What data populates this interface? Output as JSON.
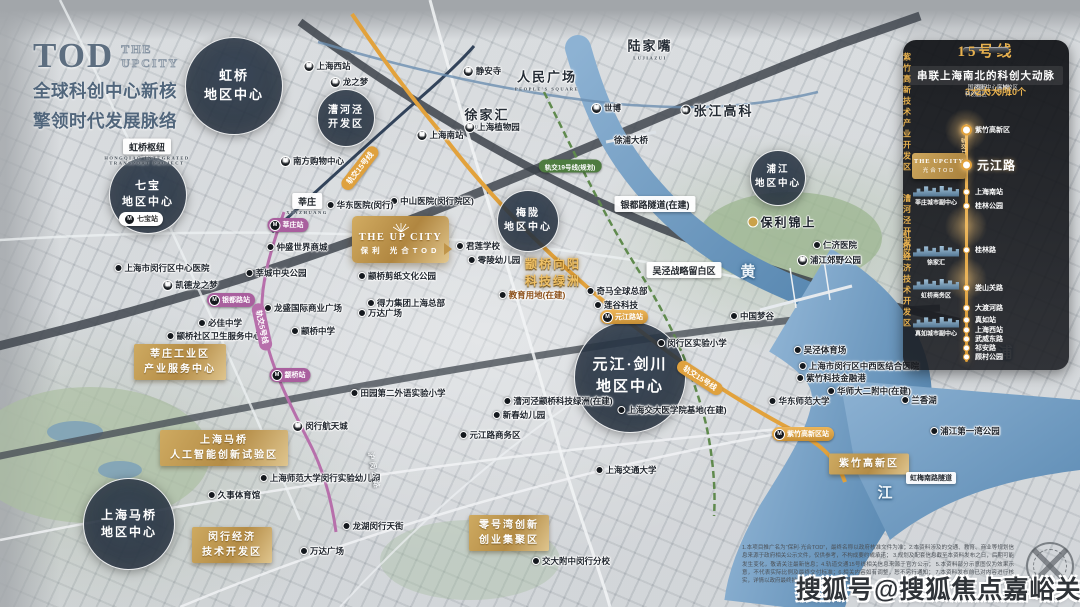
{
  "title_block": {
    "logo": "TOD",
    "logo_sub1": "THE",
    "logo_sub2": "UPCITY",
    "line1": "全球科创中心新核",
    "line2": "擎领时代发展脉络"
  },
  "project_box": {
    "en": "THE UP CITY",
    "cn": "保利 光合TOD"
  },
  "watermark": {
    "text": "搜狐号@搜狐焦点嘉峪关站"
  },
  "colors": {
    "gold": "#d8a94f",
    "panel_bg": "#16181c",
    "circle": "#2c3a4b",
    "line15": "#e2a23c",
    "line5": "#b76fab",
    "line19": "#5f8a4d",
    "line1": "#32435a",
    "river": "#6f9cbb"
  },
  "region_circles": [
    {
      "lines": [
        "虹桥",
        "地区中心"
      ],
      "x": 233,
      "y": 85,
      "r": 48,
      "fs": 13
    },
    {
      "lines": [
        "七宝",
        "地区中心"
      ],
      "x": 147,
      "y": 194,
      "r": 38,
      "fs": 11
    },
    {
      "lines": [
        "漕河泾",
        "开发区"
      ],
      "x": 345,
      "y": 117,
      "r": 28,
      "fs": 10
    },
    {
      "lines": [
        "梅陇",
        "地区中心"
      ],
      "x": 527,
      "y": 220,
      "r": 30,
      "fs": 10
    },
    {
      "lines": [
        "元江·剑川",
        "地区中心"
      ],
      "x": 629,
      "y": 376,
      "r": 55,
      "fs": 15
    },
    {
      "lines": [
        "上海马桥",
        "地区中心"
      ],
      "x": 128,
      "y": 523,
      "r": 45,
      "fs": 12
    },
    {
      "lines": [
        "浦江",
        "地区中心"
      ],
      "x": 777,
      "y": 177,
      "r": 27,
      "fs": 9.5
    }
  ],
  "gold_labels": [
    {
      "k": "pill",
      "lines": [
        "莘庄工业区",
        "产业服务中心"
      ],
      "x": 180,
      "y": 362
    },
    {
      "k": "pill",
      "lines": [
        "上海马桥",
        "人工智能创新试验区"
      ],
      "x": 224,
      "y": 448
    },
    {
      "k": "pill",
      "lines": [
        "闵行经济",
        "技术开发区"
      ],
      "x": 232,
      "y": 545
    },
    {
      "k": "pill",
      "lines": [
        "零号湾创新",
        "创业集聚区"
      ],
      "x": 509,
      "y": 533
    },
    {
      "k": "pill",
      "lines": [
        "紫竹高新区"
      ],
      "x": 869,
      "y": 464
    },
    {
      "k": "text",
      "lines": [
        "颛桥向阳",
        "科技绿洲"
      ],
      "x": 553,
      "y": 273
    }
  ],
  "map_labels": [
    {
      "t": "上海西站",
      "x": 327,
      "y": 66,
      "icon": "m"
    },
    {
      "t": "龙之梦",
      "x": 349,
      "y": 82,
      "icon": "m"
    },
    {
      "t": "静安寺",
      "x": 482,
      "y": 71,
      "icon": "m"
    },
    {
      "t": "人民广场",
      "sub": "PEOPLE'S SQUARE",
      "x": 547,
      "y": 79,
      "s": "serif"
    },
    {
      "t": "陆家嘴",
      "sub": "LUJIAZUI",
      "x": 650,
      "y": 48,
      "s": "serif"
    },
    {
      "t": "张江高科",
      "x": 717,
      "y": 110,
      "s": "serif",
      "icon": "m"
    },
    {
      "t": "徐家汇",
      "sub": "XUJIAHUI",
      "x": 487,
      "y": 117,
      "s": "serif"
    },
    {
      "t": "世博",
      "x": 606,
      "y": 108,
      "icon": "m"
    },
    {
      "t": "上海南站",
      "x": 440,
      "y": 135,
      "icon": "m"
    },
    {
      "t": "上海植物园",
      "x": 492,
      "y": 127,
      "icon": "m"
    },
    {
      "t": "徐浦大桥",
      "x": 631,
      "y": 140
    },
    {
      "t": "南方购物中心",
      "x": 312,
      "y": 161,
      "icon": "m"
    },
    {
      "t": "虹桥枢纽",
      "sub": "HONGQIAO INTEGRATED TRANSPORT PROJECT",
      "x": 147,
      "y": 152,
      "s": "tag"
    },
    {
      "t": "莘庄",
      "sub": "XINZHUANG",
      "x": 307,
      "y": 204,
      "s": "tag"
    },
    {
      "t": "银都路隧道(在建)",
      "x": 655,
      "y": 204,
      "s": "tag"
    },
    {
      "t": "吴泾战略留白区",
      "x": 684,
      "y": 270,
      "s": "tag"
    },
    {
      "t": "虹梅南路隧道",
      "x": 931,
      "y": 478,
      "s": "tag-s"
    },
    {
      "t": "保利锦上",
      "x": 782,
      "y": 222,
      "s": "poi",
      "icon": "pin"
    },
    {
      "t": "仲盛世界商城",
      "x": 297,
      "y": 247,
      "icon": "dot"
    },
    {
      "t": "莘城中央公园",
      "x": 276,
      "y": 273,
      "icon": "dot"
    },
    {
      "t": "上海市闵行区中心医院",
      "x": 162,
      "y": 268,
      "icon": "dot"
    },
    {
      "t": "凯德龙之梦",
      "x": 190,
      "y": 285,
      "icon": "m"
    },
    {
      "t": "龙盛国际商业广场",
      "x": 303,
      "y": 308,
      "icon": "dot"
    },
    {
      "t": "必佳中学",
      "x": 220,
      "y": 323,
      "icon": "dot"
    },
    {
      "t": "颛桥社区卫生服务中心",
      "x": 214,
      "y": 336,
      "icon": "dot"
    },
    {
      "t": "颛桥中学",
      "x": 313,
      "y": 331,
      "icon": "dot"
    },
    {
      "t": "中山医院(闵行院区)",
      "x": 432,
      "y": 201,
      "icon": "dot"
    },
    {
      "t": "华东医院(闵行)",
      "x": 360,
      "y": 205,
      "icon": "dot"
    },
    {
      "t": "君莲学校",
      "x": 478,
      "y": 246,
      "icon": "dot"
    },
    {
      "t": "零陵幼儿园",
      "x": 494,
      "y": 260,
      "icon": "dot"
    },
    {
      "t": "颛桥剪纸文化公园",
      "x": 397,
      "y": 276,
      "icon": "dot"
    },
    {
      "t": "得力集团上海总部",
      "x": 406,
      "y": 303,
      "icon": "dot"
    },
    {
      "t": "万达广场",
      "x": 380,
      "y": 313,
      "icon": "dot"
    },
    {
      "t": "教育用地(在建)",
      "x": 532,
      "y": 295,
      "icon": "dot",
      "s": "orange"
    },
    {
      "t": "奇马全球总部",
      "x": 617,
      "y": 291,
      "icon": "dot"
    },
    {
      "t": "莲谷科技",
      "x": 616,
      "y": 305,
      "icon": "dot"
    },
    {
      "t": "中国梦谷",
      "x": 752,
      "y": 316,
      "icon": "dot"
    },
    {
      "t": "闵行区实验小学",
      "x": 692,
      "y": 343,
      "icon": "dot"
    },
    {
      "t": "吴泾体育场",
      "x": 820,
      "y": 350,
      "icon": "dot"
    },
    {
      "t": "上海市闵行区中西医结合医院",
      "x": 859,
      "y": 366,
      "icon": "dot"
    },
    {
      "t": "紫竹科技金融港",
      "x": 831,
      "y": 378,
      "icon": "dot"
    },
    {
      "t": "华师大二附中(在建)",
      "x": 869,
      "y": 391,
      "icon": "dot"
    },
    {
      "t": "华东师范大学",
      "x": 799,
      "y": 401,
      "icon": "dot"
    },
    {
      "t": "兰香湖",
      "x": 919,
      "y": 400,
      "icon": "dot"
    },
    {
      "t": "浦江第一湾公园",
      "x": 965,
      "y": 431,
      "icon": "dot"
    },
    {
      "t": "上海交通大学",
      "x": 626,
      "y": 470,
      "icon": "dot"
    },
    {
      "t": "上海交大医学院基地(在建)",
      "x": 672,
      "y": 410,
      "icon": "dot"
    },
    {
      "t": "田园第二外语实验小学",
      "x": 398,
      "y": 393,
      "icon": "dot"
    },
    {
      "t": "漕河泾颛桥科技绿洲(在建)",
      "x": 558,
      "y": 401,
      "icon": "dot"
    },
    {
      "t": "新春幼儿园",
      "x": 519,
      "y": 415,
      "icon": "dot"
    },
    {
      "t": "元江路商务区",
      "x": 490,
      "y": 435,
      "icon": "dot"
    },
    {
      "t": "闵行航天城",
      "x": 320,
      "y": 426,
      "icon": "m"
    },
    {
      "t": "上海师范大学闵行实验幼儿园",
      "x": 320,
      "y": 478,
      "icon": "dot"
    },
    {
      "t": "久事体育馆",
      "x": 234,
      "y": 495,
      "icon": "dot"
    },
    {
      "t": "万达广场",
      "x": 322,
      "y": 551,
      "icon": "dot"
    },
    {
      "t": "龙湖闵行天街",
      "x": 373,
      "y": 526,
      "icon": "dot"
    },
    {
      "t": "交大附中闵行分校",
      "x": 571,
      "y": 561,
      "icon": "dot"
    },
    {
      "t": "仁济医院",
      "x": 835,
      "y": 245,
      "icon": "dot"
    },
    {
      "t": "浦江郊野公园",
      "x": 829,
      "y": 260,
      "icon": "m"
    },
    {
      "t": "元江路站",
      "x": 624,
      "y": 317,
      "s": "bgold",
      "icon": "m"
    },
    {
      "t": "紫竹高新区站",
      "x": 803,
      "y": 434,
      "s": "bgold",
      "icon": "m"
    },
    {
      "t": "七宝站",
      "x": 141,
      "y": 219,
      "s": "bwhite",
      "icon": "m"
    },
    {
      "t": "莘庄站",
      "x": 288,
      "y": 225,
      "s": "bpink",
      "icon": "m"
    },
    {
      "t": "银都路站",
      "x": 231,
      "y": 300,
      "s": "bpink",
      "icon": "m"
    },
    {
      "t": "颛桥站",
      "x": 290,
      "y": 375,
      "s": "bpink",
      "icon": "m"
    },
    {
      "t": "轨交19号线(规划)",
      "x": 570,
      "y": 166,
      "s": "bgreen"
    },
    {
      "t": "轨交15号线",
      "x": 360,
      "y": 168,
      "rot": -52,
      "s": "rgold"
    },
    {
      "t": "轨交15号线",
      "x": 700,
      "y": 378,
      "rot": 33,
      "s": "rgold"
    },
    {
      "t": "轨交5号线",
      "x": 262,
      "y": 327,
      "rot": 78,
      "s": "rpink"
    },
    {
      "t": "沪闵公路",
      "x": 374,
      "y": 471,
      "rot": 80,
      "s": "rgray"
    }
  ],
  "river_chars": [
    {
      "t": "黄",
      "x": 749,
      "y": 271
    },
    {
      "t": "浦",
      "x": 1006,
      "y": 352
    },
    {
      "t": "江",
      "x": 886,
      "y": 492
    }
  ],
  "panel": {
    "line_name": "15号线",
    "headline": "串联上海南北的科创大动脉",
    "stats": [
      {
        "n": "3大",
        "t": "国家级\n科创园区"
      },
      {
        "n": "2大",
        "t": "枢纽"
      },
      {
        "n": "3大",
        "t": "中心区域"
      },
      {
        "n": "9所",
        "t": "高校"
      },
      {
        "n": "10个",
        "t": "校区"
      }
    ],
    "line_label": "轨交15号线",
    "callout_l1": "THE UPCITY",
    "callout_l2": "光合TOD",
    "sections": [
      {
        "t": "紫竹高新技术产业开发区",
        "y": 72
      },
      {
        "t": "漕河泾开发区",
        "y": 186,
        "glow": true
      },
      {
        "t": "虹桥经济技术开发区",
        "y": 239,
        "glow": true
      }
    ],
    "stations": [
      {
        "name": "紫竹高新区",
        "y": 90,
        "glow": true
      },
      {
        "name": "元江路",
        "y": 125,
        "major": true
      },
      {
        "name": "上海南站",
        "y": 152,
        "badge": "换乘1/3号线"
      },
      {
        "name": "桂林公园",
        "y": 166,
        "badge": "换乘12号线"
      },
      {
        "name": "桂林路",
        "y": 210,
        "badge": "换乘9号线"
      },
      {
        "name": "娄山关路",
        "y": 248,
        "badge": "换乘2号线"
      },
      {
        "name": "大渡河路",
        "y": 268,
        "badge": "换乘13号线"
      },
      {
        "name": "真如站",
        "y": 280,
        "badge": "换乘14号线"
      },
      {
        "name": "上海西站",
        "y": 290,
        "badge": "换乘11号线"
      },
      {
        "name": "武威东路",
        "y": 299
      },
      {
        "name": "祁安路",
        "y": 308
      },
      {
        "name": "顾村公园",
        "y": 317,
        "badge": "换乘7号线"
      }
    ],
    "universities": [
      {
        "t": "华东师范大学(闵行)",
        "y": 82
      },
      {
        "t": "上海交通大学(闵行)",
        "y": 96
      },
      {
        "t": "华东理工大学",
        "y": 146
      },
      {
        "t": "上海师范大学",
        "y": 159
      },
      {
        "t": "上海工程技术大学",
        "y": 227
      },
      {
        "t": "对外经贸大学",
        "y": 248
      },
      {
        "t": "华东师范大学(普陀)",
        "y": 268
      },
      {
        "t": "同济大学",
        "y": 299
      },
      {
        "t": "上海大学",
        "y": 308
      }
    ],
    "side_labels": [
      {
        "t": "莘庄城市副中心",
        "y": 156
      },
      {
        "t": "徐家汇",
        "y": 216
      },
      {
        "t": "虹桥商务区",
        "y": 249
      },
      {
        "t": "真如城市副中心",
        "y": 287
      }
    ]
  },
  "disclaimer_lines": [
    "1.本项目推广名为“保利·光合TOD”，最终名称以政府核准文件为准；2.本资料涉及的交通、教育、商业等规划信息来源于政府相关公示文件，仅供参考，不构成要约或承诺；",
    "3.规划及配套信息截至本资料发布之日，后期可能发生变化，敬请关注最新信息；4.轨道交通15号线相关信息来源于官方公示；",
    "5.本资料部分示意图仅为效果示意，不代表实际比例及最终交付标准；6.相关内容如有调整，恕不另行通知；",
    "7.本资料发布前已对内容进行核实，详情以政府最终批复文件为准，敬请知悉。"
  ]
}
